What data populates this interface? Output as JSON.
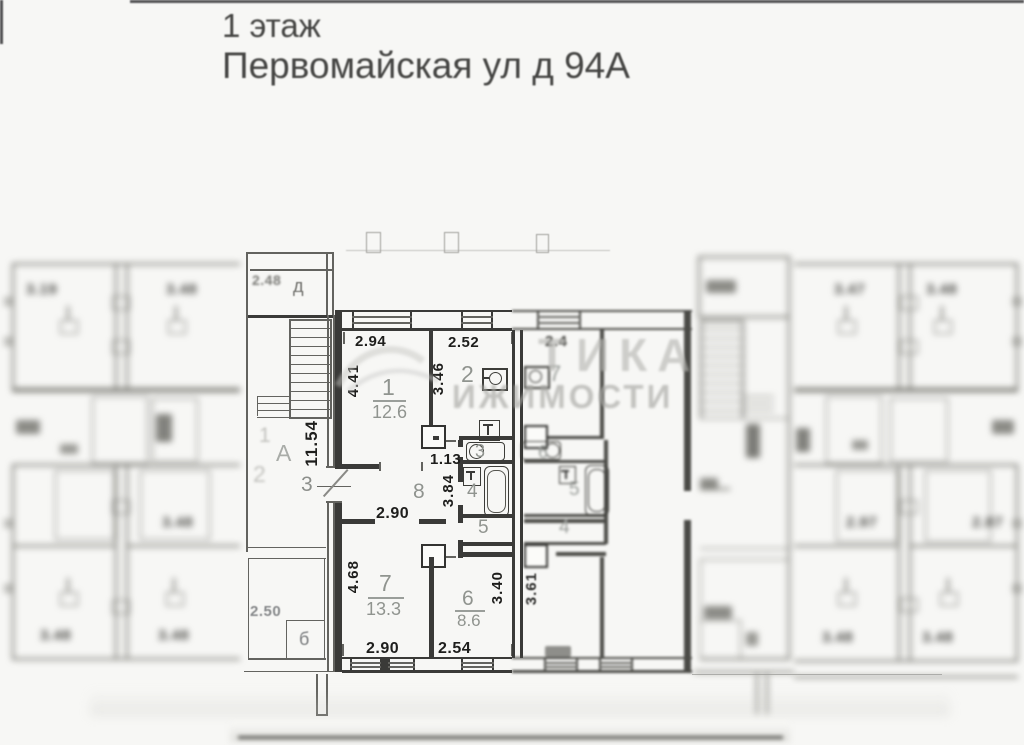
{
  "title": {
    "line1": "1 этаж",
    "line2": "Первомайская ул д 94А"
  },
  "watermark": {
    "line1": "ТИКА",
    "line2": "ИЖИМОСТИ"
  },
  "apartment": {
    "room1": {
      "num": "1",
      "area": "12.6",
      "width": "2.94",
      "height": "4.41"
    },
    "room2": {
      "num": "2",
      "width": "2.52",
      "height": "3.46"
    },
    "room3": {
      "num": "3",
      "width": "1.13"
    },
    "room4": {
      "num": "4"
    },
    "room5": {
      "num": "5"
    },
    "room6": {
      "num": "6",
      "area": "8.6",
      "width": "2.54",
      "height": "3.40"
    },
    "room7": {
      "num": "7",
      "area": "13.3",
      "width": "2.90",
      "height": "4.68"
    },
    "room8": {
      "num": "8",
      "width": "2.90",
      "height": "3.84"
    }
  },
  "staircase": {
    "height_dim": "11.54",
    "section_letter": "A",
    "apartment_no": "3",
    "entry_room": "д",
    "entry_dim": "2.48",
    "storage_dim": "2.50",
    "storage_room": "б",
    "faint_no1": "1",
    "faint_no2": "2"
  },
  "neighbor": {
    "kitchen_num": "7",
    "kitchen_dim": "2.4",
    "sink_room": "6",
    "bath_room": "5",
    "small_room": "4",
    "height_dim": "3.61"
  },
  "left_wing": {
    "dim_top1": "3.19",
    "dim_top2": "3.48",
    "dim_mid": "3.48",
    "dim_bot1": "3.48",
    "dim_bot2": "3.48"
  },
  "right_wing": {
    "dim_top1": "3.47",
    "dim_top2": "3.48",
    "dim_mid1": "2.97",
    "dim_mid2": "2.87",
    "dim_bot1": "3.48",
    "dim_bot2": "3.48"
  }
}
